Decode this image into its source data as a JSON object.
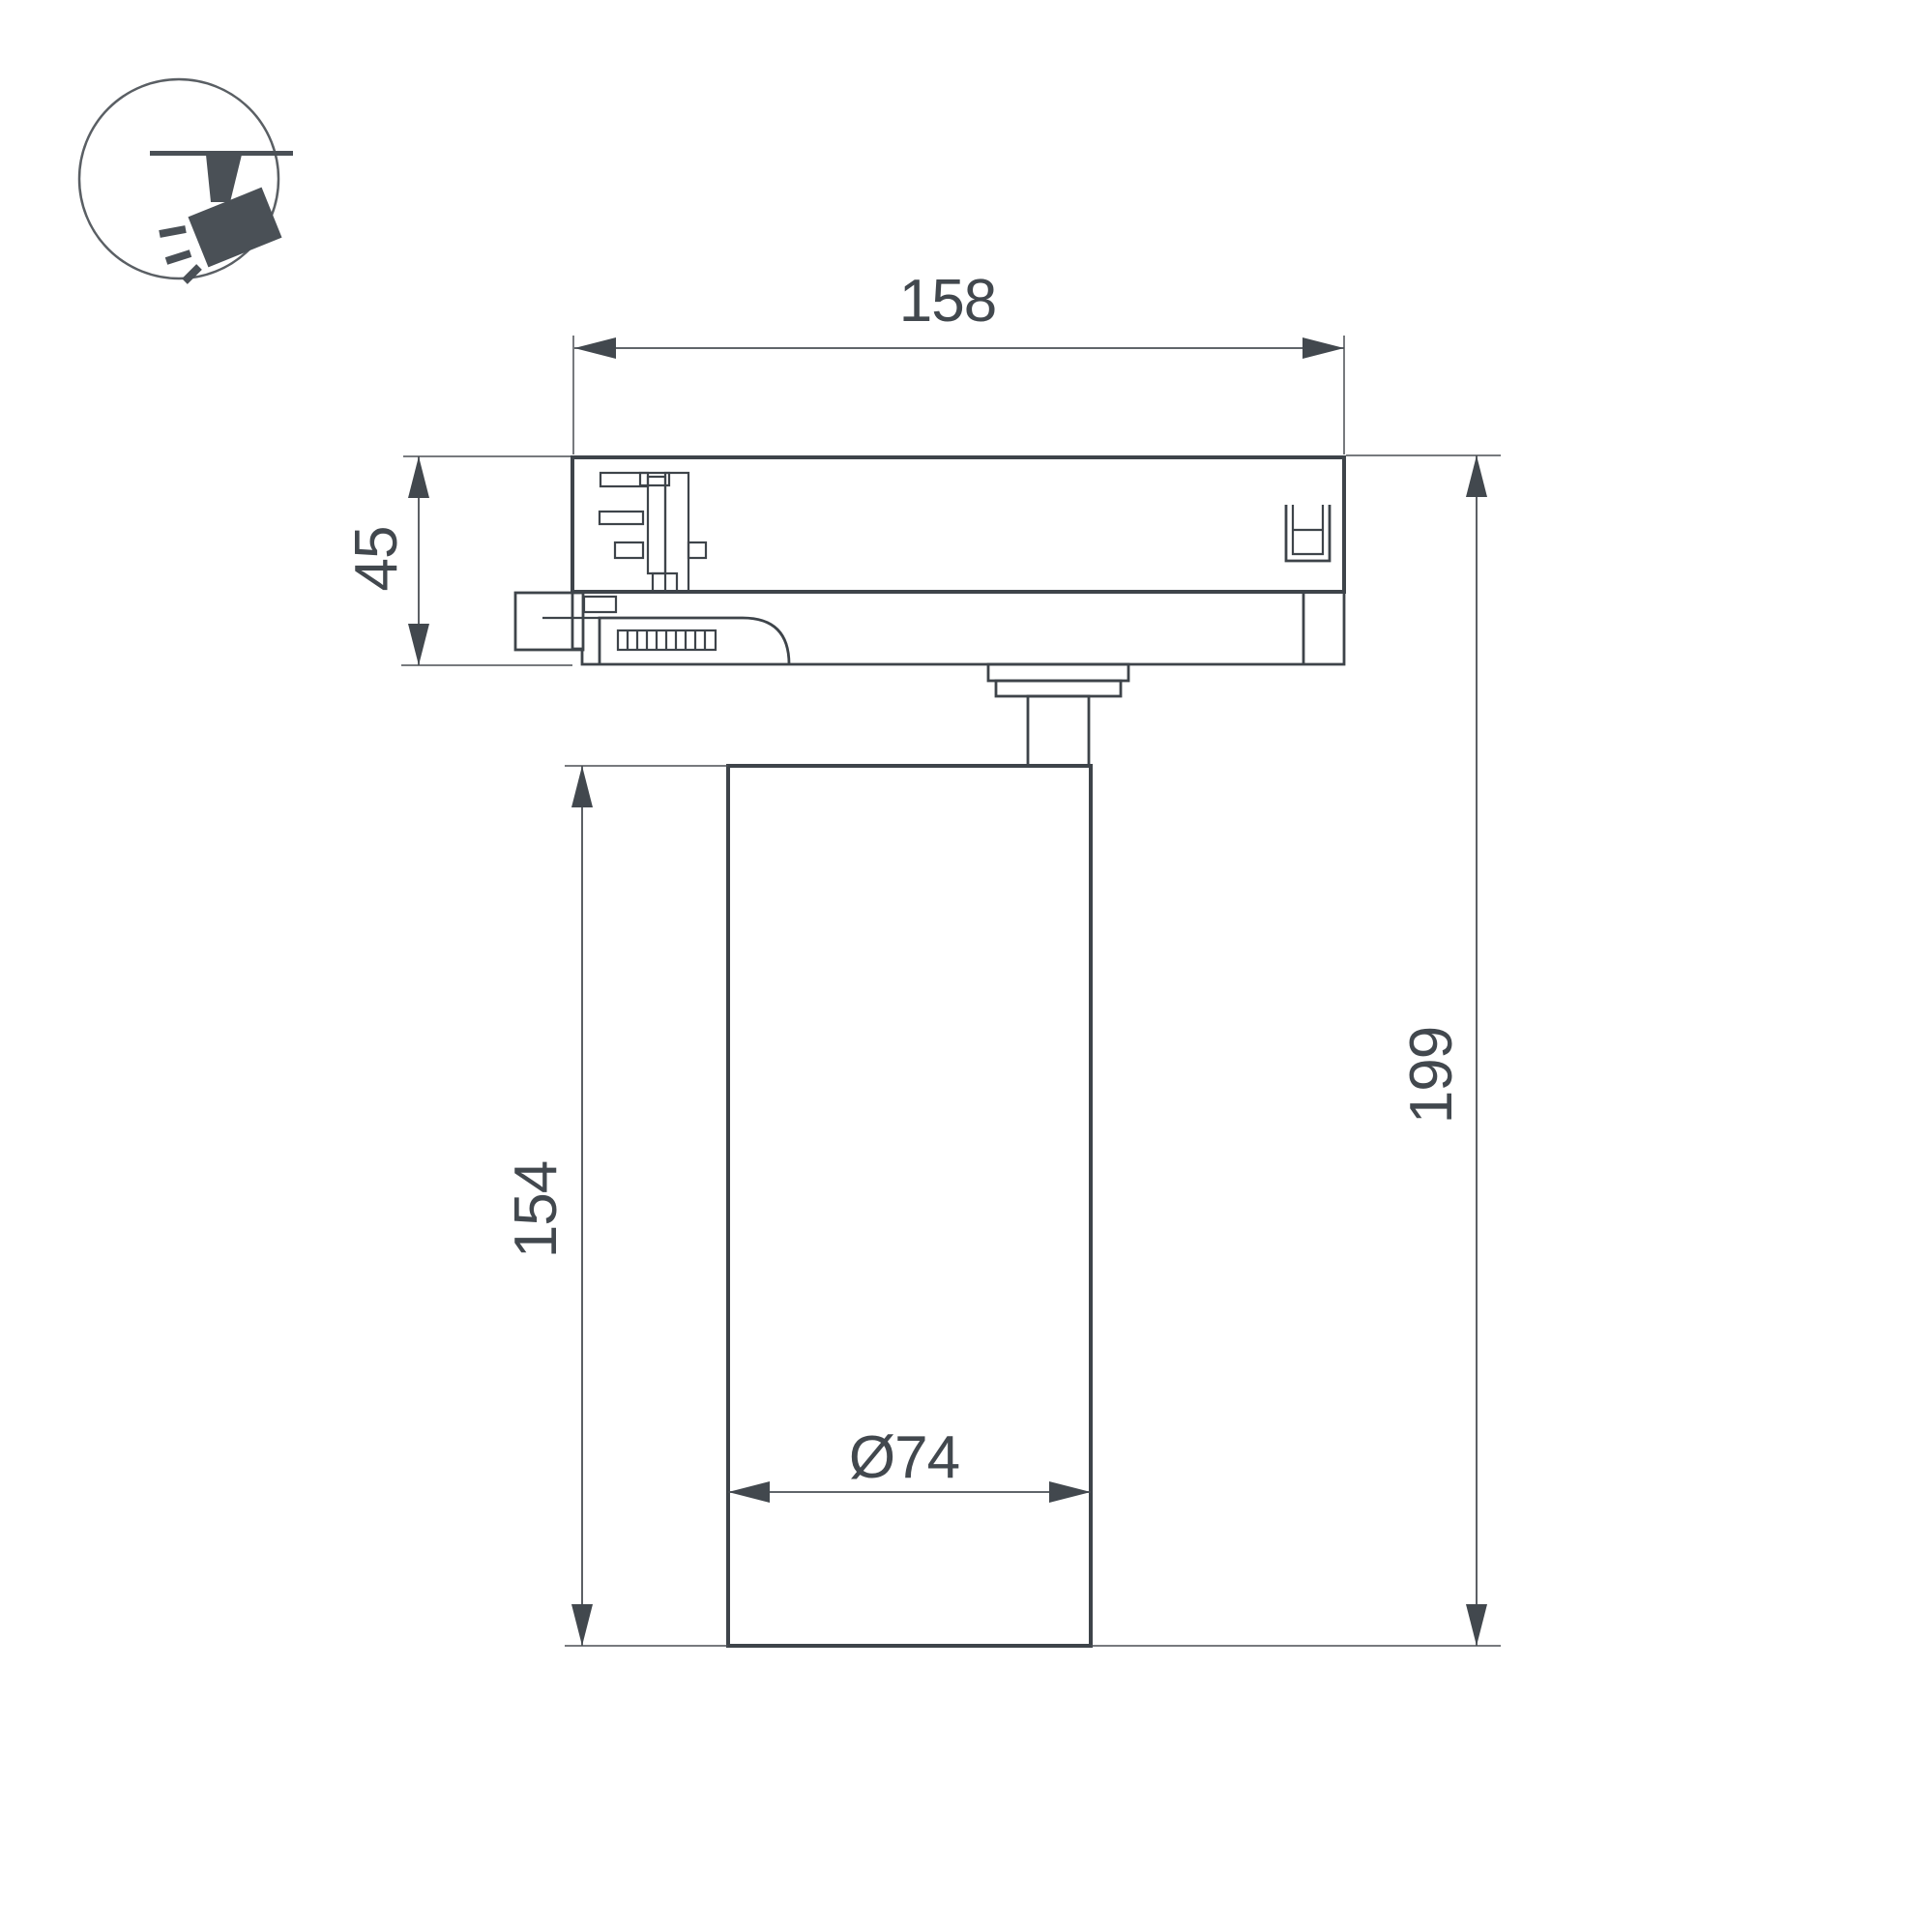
{
  "icon": {
    "name": "track-spotlight-pictogram"
  },
  "dims": {
    "track_width": {
      "label": "158"
    },
    "adapter_height": {
      "label": "45"
    },
    "body_height": {
      "label": "154"
    },
    "total_height": {
      "label": "199"
    },
    "body_diameter": {
      "label": "Ø74"
    }
  },
  "colors": {
    "outline": "#3e444a",
    "dimension_line": "#4a4f54",
    "label_text": "#42484e",
    "icon_fill": "#4a5056",
    "background": "#ffffff"
  }
}
